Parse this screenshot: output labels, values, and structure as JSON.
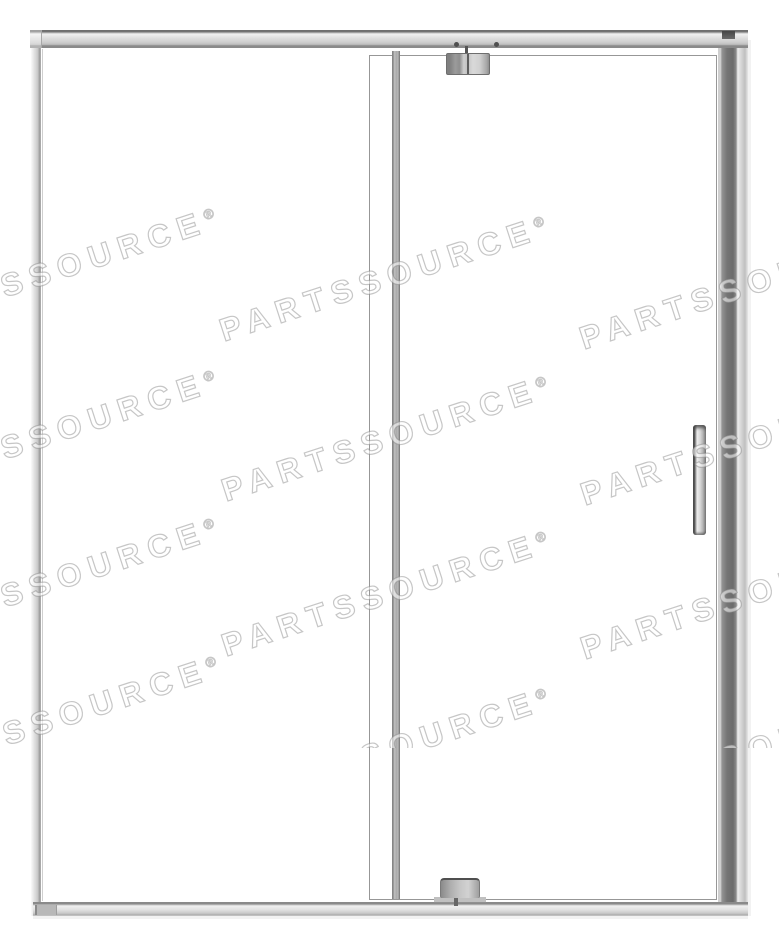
{
  "watermark": {
    "text": "PARTSSOURCE",
    "reg": "®",
    "angle_deg": -18
  },
  "colors": {
    "frame-edge": "#8f8f8f",
    "frame-dark": "#6e6e6e",
    "frame-light": "#dcdcdc",
    "hinge-dark": "#4f4f4f",
    "glass-line": "#979797",
    "wm-outline": "rgba(128,128,128,0.45)",
    "wm-fill": "rgba(255,255,255,0.55)"
  },
  "product_photo": {
    "background": "#ffffff",
    "subject": "framed glass pivot shower door with right-side handle"
  }
}
